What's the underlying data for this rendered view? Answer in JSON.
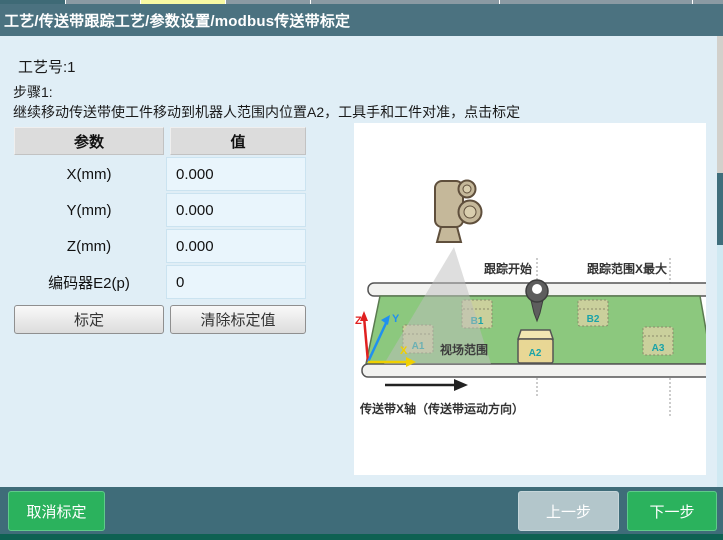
{
  "title_bar": {
    "title": "工艺/传送带跟踪工艺/参数设置/modbus传送带标定"
  },
  "tab_strip": {
    "segments": [
      {
        "x": 0,
        "w": 65,
        "color": "#3e6a76"
      },
      {
        "x": 66,
        "w": 74,
        "color": "#8b9aa3"
      },
      {
        "x": 141,
        "w": 84,
        "color": "#f7f9a3"
      },
      {
        "x": 226,
        "w": 84,
        "color": "#8b9aa3"
      },
      {
        "x": 311,
        "w": 188,
        "color": "#8b9aa3"
      },
      {
        "x": 500,
        "w": 192,
        "color": "#8b9aa3"
      },
      {
        "x": 693,
        "w": 30,
        "color": "#8b9aa3"
      }
    ]
  },
  "content": {
    "process_no": "工艺号:1",
    "step": "步骤1:",
    "instruction": "继续移动传送带使工件移动到机器人范围内位置A2，工具手和工件对准，点击标定",
    "table": {
      "headers": [
        "参数",
        "值"
      ],
      "rows": [
        {
          "param": "X(mm)",
          "value": "0.000"
        },
        {
          "param": "Y(mm)",
          "value": "0.000"
        },
        {
          "param": "Z(mm)",
          "value": "0.000"
        },
        {
          "param": "编码器E2(p)",
          "value": "0"
        }
      ]
    },
    "buttons": {
      "calibrate": "标定",
      "clear": "清除标定值"
    }
  },
  "diagram": {
    "tracking_start": "跟踪开始",
    "tracking_max": "跟踪范围X最大",
    "fov": "视场范围",
    "belt_axis": "传送带X轴（传送带运动方向）",
    "axes": {
      "x": "X",
      "y": "Y",
      "z": "Z"
    },
    "boxes": {
      "a1": "A1",
      "a2": "A2",
      "a3": "A3",
      "b1": "B1",
      "b2": "B2"
    }
  },
  "bottom_bar": {
    "cancel": "取消标定",
    "prev": "上一步",
    "next": "下一步"
  },
  "colors": {
    "title_bar": "#4b7280",
    "content_bg": "#e0eef6",
    "accent_green": "#2bb25d",
    "bottom_bar": "#3f6c79",
    "belt_green": "#8cc87e",
    "box_tan": "#e8d795",
    "label_teal": "#1aa3a8"
  }
}
